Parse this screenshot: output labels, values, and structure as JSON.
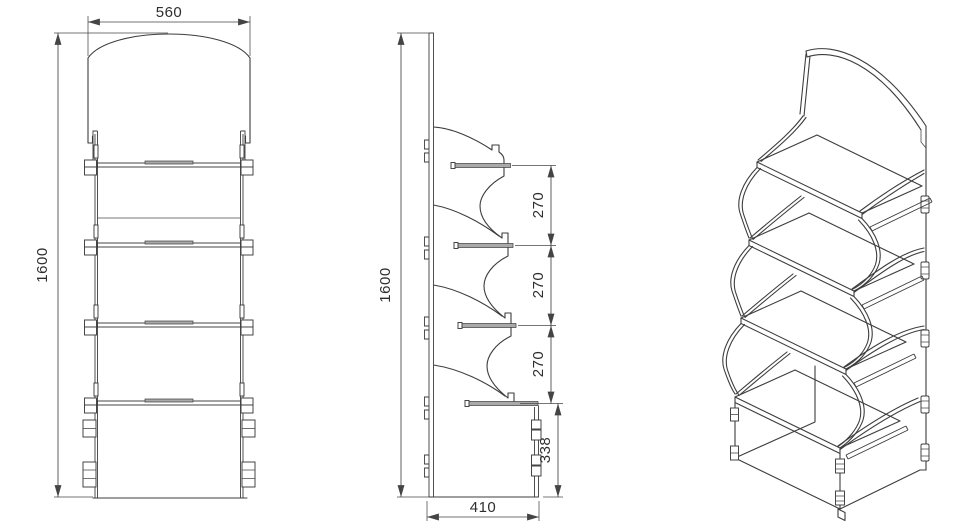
{
  "drawing": {
    "type": "technical-orthographic-drawing",
    "subject": "four-shelf retail display stand",
    "views": {
      "front": "front-view",
      "side": "side-view",
      "iso": "isometric-view"
    },
    "dim_labels": {
      "front_width": "560",
      "front_height": "1600",
      "side_height": "1600",
      "spacing_top": "270",
      "spacing_mid": "270",
      "spacing_bottom": "270",
      "base_height": "338",
      "base_depth": "410"
    },
    "colors": {
      "line": "#3d3d3d",
      "background": "#ffffff",
      "shading": "#a9a9a9"
    }
  }
}
